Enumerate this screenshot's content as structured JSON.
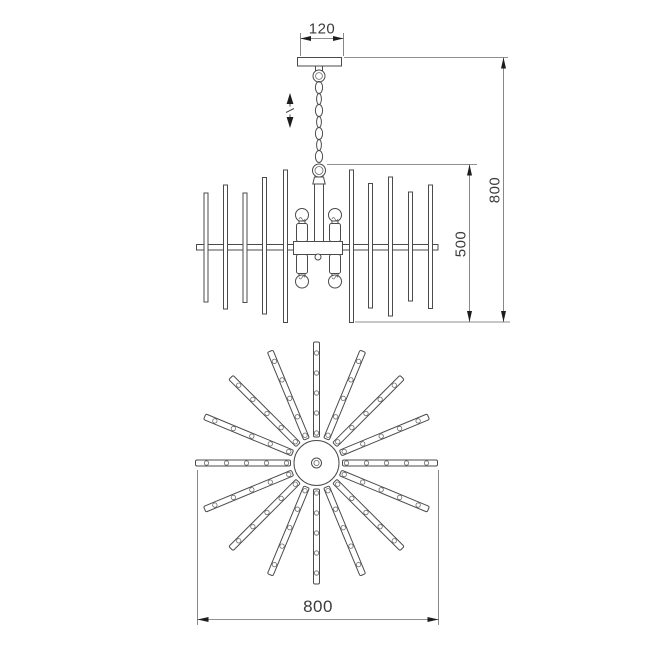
{
  "page": {
    "background": "#ffffff"
  },
  "drawing": {
    "line_color": "#4b4b4b",
    "text_color": "#3c3c3c",
    "dimensions": {
      "canopy_width": "120",
      "overall_height": "800",
      "body_height": "500",
      "diameter": "800"
    },
    "front_view": {
      "chain_links": 7,
      "vertical_rods": 10,
      "bulbs": 4
    },
    "plan_view": {
      "radial_arms": 16,
      "beads_per_arm": 5
    },
    "icons": {
      "height_adjust": "vertical-double-arrow-with-slash"
    }
  }
}
